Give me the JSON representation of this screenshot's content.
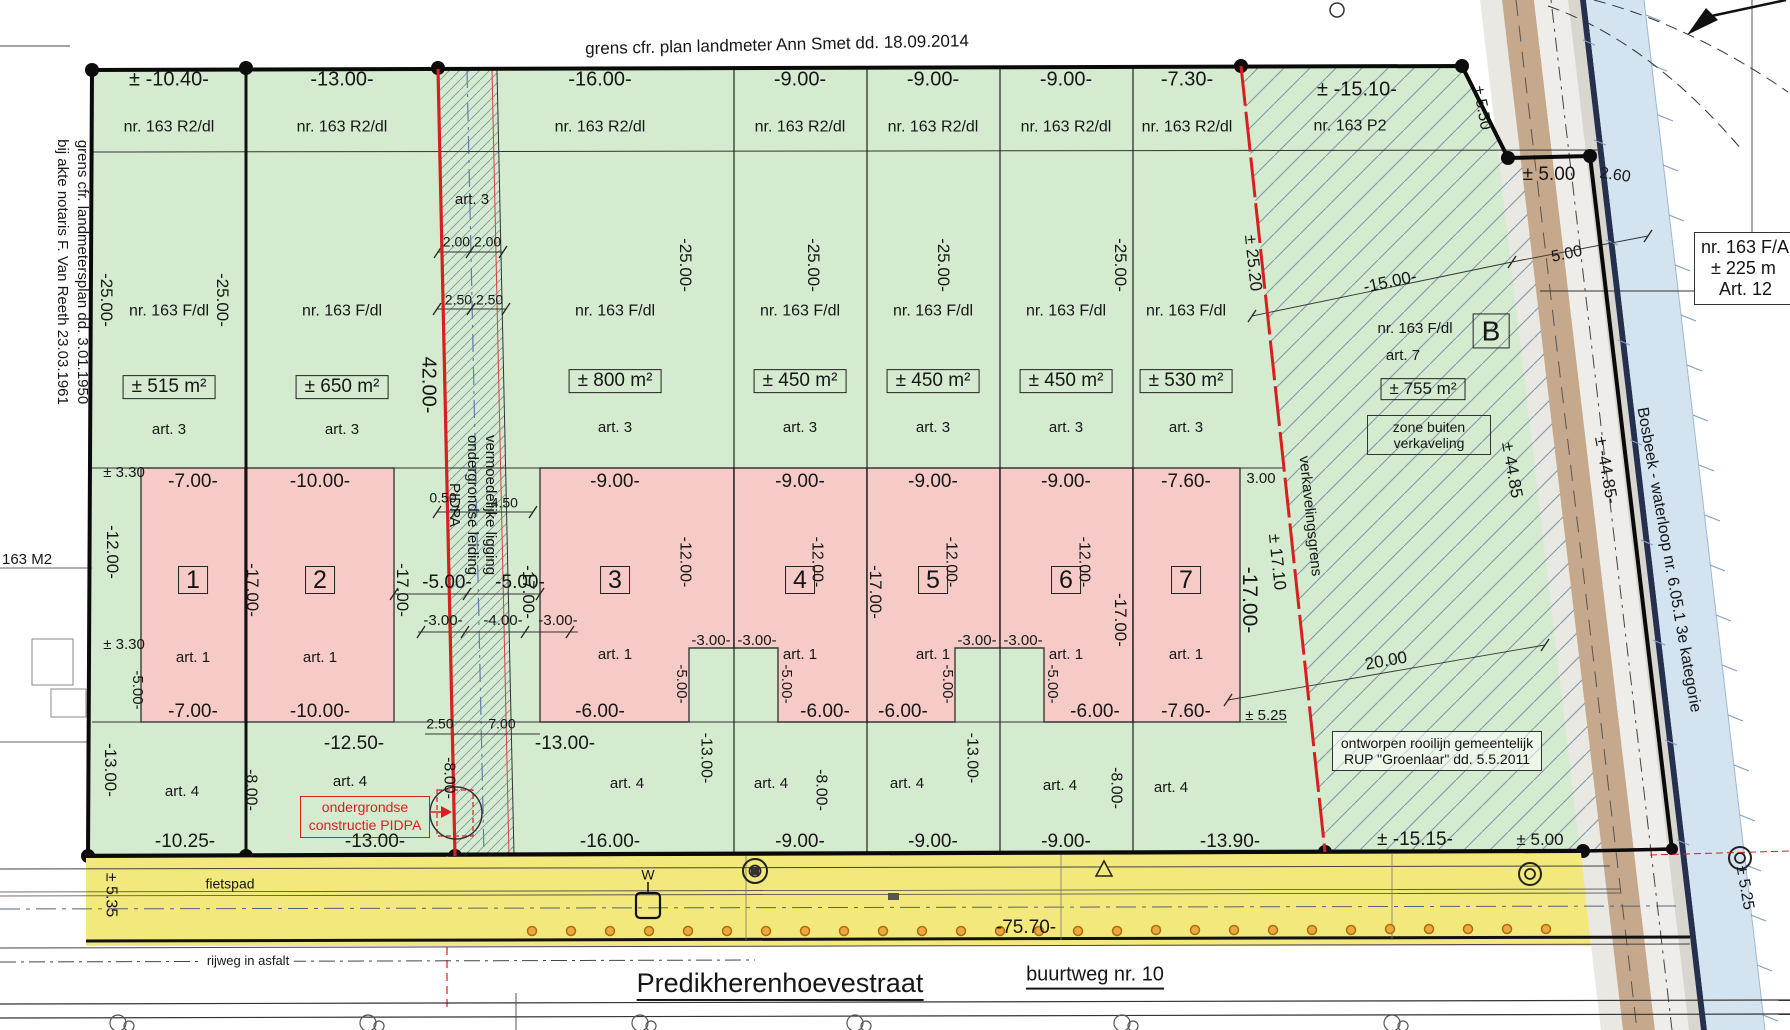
{
  "notes": {
    "top": "grens cfr. plan landmeter Ann Smet dd. 18.09.2014",
    "left1": "grens cfr. landmetersplan dd. 3.01.1950",
    "left2": "bij akte notaris F. Van Reeth 23.03.1961",
    "neighbor_left": "163 M2"
  },
  "street": {
    "name": "Predikherenhoevestraat",
    "buurtweg": "buurtweg nr. 10",
    "rijweg": "rijweg in asfalt",
    "fietspad": "fietspad",
    "total": "-75.70-",
    "left": "± 5.35",
    "right": "± 5.25"
  },
  "lots": [
    {
      "num": "1",
      "top": "± -10.40-",
      "nr_top": "nr. 163 R2/dl",
      "nr": "nr. 163 F/dl",
      "area": "± 515 m²",
      "art_top": "art. 3",
      "art_house": "art. 1",
      "art_bottom": "art. 4",
      "house_top": "-7.00-",
      "house_bottom": "-7.00-",
      "bottom": "-10.25-"
    },
    {
      "num": "2",
      "top": "-13.00-",
      "nr_top": "nr. 163 R2/dl",
      "nr": "nr. 163 F/dl",
      "area": "± 650 m²",
      "art_top": "art. 3",
      "art_house": "art. 1",
      "art_bottom": "art. 4",
      "house_top": "-10.00-",
      "house_bottom": "-10.00-",
      "bottom": "-13.00-"
    },
    {
      "num": "3",
      "top": "-16.00-",
      "nr_top": "nr. 163 R2/dl",
      "nr": "nr. 163 F/dl",
      "area": "± 800 m²",
      "art_top": "art. 3",
      "art_house": "art. 1",
      "art_bottom": "art. 4",
      "house_top": "-9.00-",
      "house_bottom": "-6.00-",
      "bottom": "-16.00-"
    },
    {
      "num": "4",
      "top": "-9.00-",
      "nr_top": "nr. 163 R2/dl",
      "nr": "nr. 163 F/dl",
      "area": "± 450 m²",
      "art_top": "art. 3",
      "art_house": "art. 1",
      "art_bottom": "art. 4",
      "house_top": "-9.00-",
      "house_bottom": "-6.00-",
      "bottom": "-9.00-"
    },
    {
      "num": "5",
      "top": "-9.00-",
      "nr_top": "nr. 163 R2/dl",
      "nr": "nr. 163 F/dl",
      "area": "± 450 m²",
      "art_top": "art. 3",
      "art_house": "art. 1",
      "art_bottom": "art. 4",
      "house_top": "-9.00-",
      "house_bottom": "-6.00-",
      "bottom": "-9.00-"
    },
    {
      "num": "6",
      "top": "-9.00-",
      "nr_top": "nr. 163 R2/dl",
      "nr": "nr. 163 F/dl",
      "area": "± 450 m²",
      "art_top": "art. 3",
      "art_house": "art. 1",
      "art_bottom": "art. 4",
      "house_top": "-9.00-",
      "house_bottom": "-6.00-",
      "bottom": "-9.00-"
    },
    {
      "num": "7",
      "top": "-7.30-",
      "nr_top": "nr. 163 R2/dl",
      "nr": "nr. 163 F/dl",
      "area": "± 530 m²",
      "art_top": "art. 3",
      "art_house": "art. 1",
      "art_bottom": "art. 4",
      "house_top": "-7.60-",
      "house_bottom": "-7.60-",
      "bottom": "-13.90-"
    }
  ],
  "corridor": {
    "art": "art. 3",
    "d1": "2.00 2.00",
    "d2": "2.50 2.50",
    "depth": "42.00-",
    "r1": "vermoedelijke ligging",
    "r2": "ondergrondse leiding",
    "r3": "PIDPA",
    "off1": "0.50",
    "off2": "-4.50",
    "g_l": "-5.00-",
    "g_r": "-5.00-",
    "b1": "-3.00-",
    "b2": "-4.00-",
    "b3": "-3.00-",
    "b4": "2.50",
    "b5": "7.00"
  },
  "side": {
    "d25": "-25.00-",
    "d17": "-17.00-",
    "d12": "-12.00-",
    "d13": "-13.00-",
    "d8": "-8.00-",
    "d5": "-5.00-",
    "d330": "± 3.30",
    "n3": "-3.00-",
    "n5": "-5.00-"
  },
  "misc": {
    "d1250": "-12.50-"
  },
  "zoneB": {
    "width": "± -15.10-",
    "nr_top": "nr. 163 P2",
    "nr": "nr. 163 F/dl",
    "art": "art. 7",
    "area": "± 755 m²",
    "note1": "zone buiten",
    "note2": "verkaveling",
    "letter": "B",
    "grens": "verkavelingsgrens",
    "d1": "± 25.20",
    "d2": "± 17.10",
    "d3": "3.00",
    "d4": "± 5.25",
    "d5": "20.00",
    "d15": "-15.00-",
    "bottom": "± -15.15-"
  },
  "right": {
    "d550": "± 5.50",
    "d500": "± 5.00",
    "d260": "2.60",
    "d500b": "5.00",
    "d4485a": "± 44.85",
    "d4485b": "± -44.85-",
    "bosbeek": "Bosbeek - waterloop nr. 6.05.1 3e kategorie",
    "bottom500": "± 5.00"
  },
  "boxes": {
    "rup1": "ontworpen rooilijn gemeentelijk",
    "rup2": "RUP \"Groenlaar\" dd. 5.5.2011",
    "pidpa1": "ondergrondse",
    "pidpa2": "constructie PIDPA",
    "nb1": "nr. 163 F/A",
    "nb2": "± 225 m",
    "nb3": "Art. 12",
    "w": "W"
  }
}
